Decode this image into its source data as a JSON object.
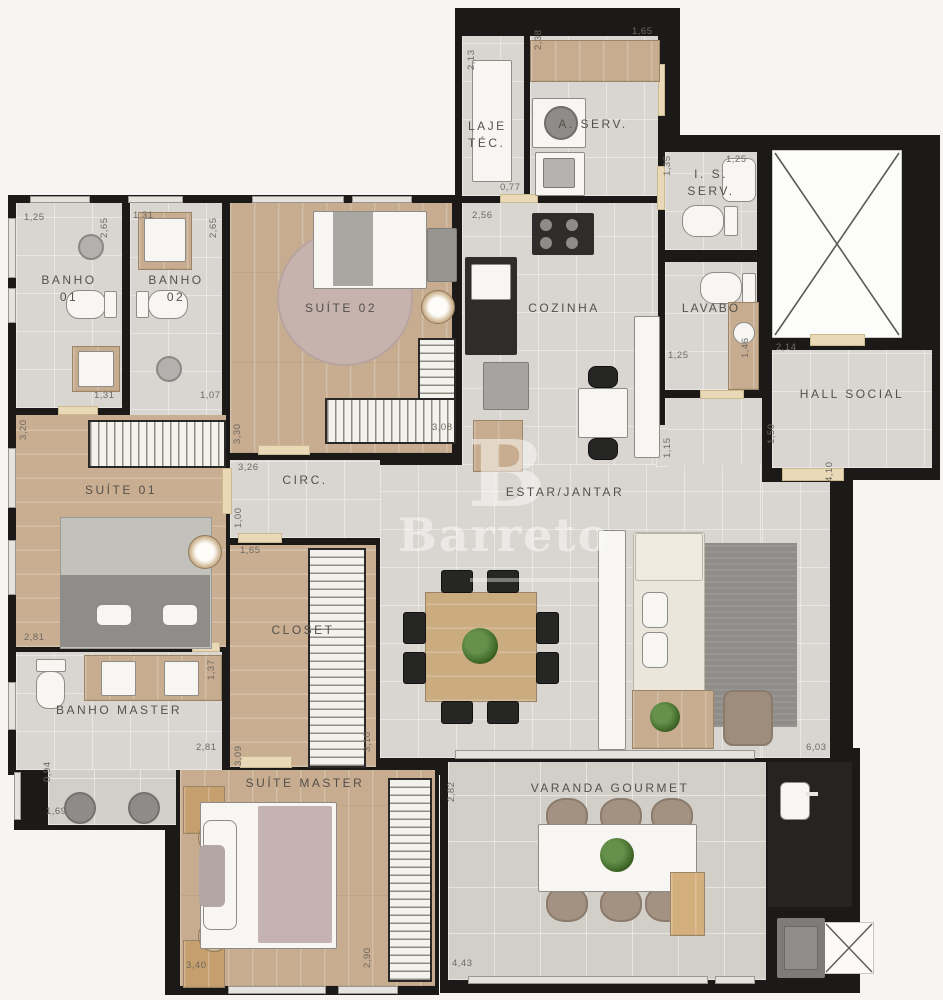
{
  "brand": {
    "initial": "B",
    "name": "Barreto"
  },
  "rooms": {
    "laje_tec": {
      "label": "LAJE\nTÉC."
    },
    "a_serv": {
      "label": "A. SERV."
    },
    "is_serv": {
      "label": "I. S.\nSERV."
    },
    "banho_01": {
      "label": "BANHO\n01"
    },
    "banho_02": {
      "label": "BANHO\n02"
    },
    "suite_02": {
      "label": "SUÍTE 02"
    },
    "cozinha": {
      "label": "COZINHA"
    },
    "lavabo": {
      "label": "LAVABO"
    },
    "hall_social": {
      "label": "HALL SOCIAL"
    },
    "suite_01": {
      "label": "SUÍTE 01"
    },
    "circ": {
      "label": "CIRC."
    },
    "estar_jantar": {
      "label": "ESTAR/JANTAR"
    },
    "closet": {
      "label": "CLOSET"
    },
    "banho_master": {
      "label": "BANHO MASTER"
    },
    "suite_master": {
      "label": "SUÍTE MASTER"
    },
    "varanda_gourmet": {
      "label": "VARANDA GOURMET"
    }
  },
  "dimensions": [
    {
      "t": "1,25",
      "x": 24,
      "y": 212
    },
    {
      "t": "2,65",
      "x": 99,
      "y": 238,
      "v": true
    },
    {
      "t": "1,31",
      "x": 133,
      "y": 210
    },
    {
      "t": "2,65",
      "x": 208,
      "y": 238,
      "v": true
    },
    {
      "t": "1,31",
      "x": 94,
      "y": 390
    },
    {
      "t": "1,07",
      "x": 200,
      "y": 390
    },
    {
      "t": "2,13",
      "x": 466,
      "y": 70,
      "v": true
    },
    {
      "t": "2,38",
      "x": 533,
      "y": 50,
      "v": true
    },
    {
      "t": "1,65",
      "x": 632,
      "y": 26
    },
    {
      "t": "0,77",
      "x": 500,
      "y": 182
    },
    {
      "t": "2,56",
      "x": 472,
      "y": 210
    },
    {
      "t": "1,35",
      "x": 662,
      "y": 176,
      "v": true
    },
    {
      "t": "1,25",
      "x": 726,
      "y": 154
    },
    {
      "t": "1,25",
      "x": 668,
      "y": 350
    },
    {
      "t": "1,46",
      "x": 740,
      "y": 358,
      "v": true
    },
    {
      "t": "1,15",
      "x": 662,
      "y": 458,
      "v": true
    },
    {
      "t": "2,14",
      "x": 776,
      "y": 342
    },
    {
      "t": "1,50",
      "x": 766,
      "y": 444,
      "v": true
    },
    {
      "t": "4,10",
      "x": 824,
      "y": 482,
      "v": true
    },
    {
      "t": "3,20",
      "x": 18,
      "y": 440,
      "v": true
    },
    {
      "t": "3,30",
      "x": 232,
      "y": 444,
      "v": true
    },
    {
      "t": "3,26",
      "x": 238,
      "y": 462
    },
    {
      "t": "3,08",
      "x": 432,
      "y": 422
    },
    {
      "t": "1,00",
      "x": 233,
      "y": 528,
      "v": true
    },
    {
      "t": "1,65",
      "x": 240,
      "y": 545
    },
    {
      "t": "2,81",
      "x": 24,
      "y": 632
    },
    {
      "t": "1,37",
      "x": 206,
      "y": 680,
      "v": true
    },
    {
      "t": "2,81",
      "x": 196,
      "y": 742
    },
    {
      "t": "3,09",
      "x": 233,
      "y": 766,
      "v": true
    },
    {
      "t": "3,10",
      "x": 362,
      "y": 752,
      "v": true
    },
    {
      "t": "0,94",
      "x": 42,
      "y": 782,
      "v": true
    },
    {
      "t": "1,69",
      "x": 46,
      "y": 806
    },
    {
      "t": "3,40",
      "x": 186,
      "y": 960
    },
    {
      "t": "2,90",
      "x": 362,
      "y": 968,
      "v": true
    },
    {
      "t": "2,82",
      "x": 446,
      "y": 802,
      "v": true
    },
    {
      "t": "4,43",
      "x": 452,
      "y": 958
    },
    {
      "t": "6,03",
      "x": 806,
      "y": 742
    }
  ]
}
